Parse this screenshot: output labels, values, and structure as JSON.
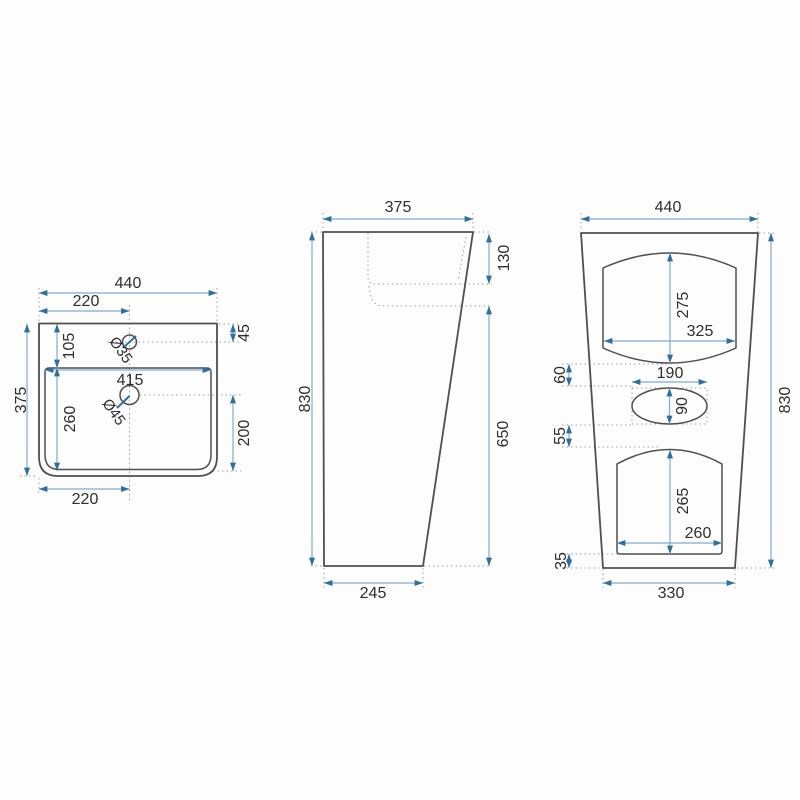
{
  "drawing": {
    "type": "technical-dimension-drawing",
    "subject": "freestanding pedestal washbasin",
    "unit": "mm",
    "colors": {
      "outline": "#4f4f4f",
      "dimension_line": "#7fadd2",
      "arrow": "#2e6f9e",
      "label": "#2e2e2e",
      "hidden_line": "#a0a0a0",
      "background": "#fdfdfd"
    },
    "views": {
      "top": {
        "name": "top view (basin plan)",
        "dims": {
          "overall_width": "440",
          "tap_hole_offset": "220",
          "tap_hole_to_back_edge": "45",
          "back_edge_to_basin": "105",
          "tap_hole_diameter": "Ø35",
          "basin_width": "415",
          "basin_depth": "260",
          "drain_to_front": "200",
          "overall_depth": "375",
          "drain_offset": "220"
        }
      },
      "side": {
        "name": "side view",
        "dims": {
          "top_depth": "375",
          "basin_depth": "130",
          "overall_height": "830",
          "height_under_basin": "650",
          "base_depth": "245"
        }
      },
      "front": {
        "name": "front view",
        "dims": {
          "overall_width": "440",
          "upper_recess_height": "275",
          "upper_recess_width": "325",
          "gap_above_oval": "60",
          "oval_width": "190",
          "oval_height": "90",
          "gap_below_oval": "55",
          "lower_recess_height": "265",
          "lower_recess_width": "260",
          "floor_clearance": "35",
          "base_width": "330",
          "overall_height": "830"
        }
      }
    }
  }
}
